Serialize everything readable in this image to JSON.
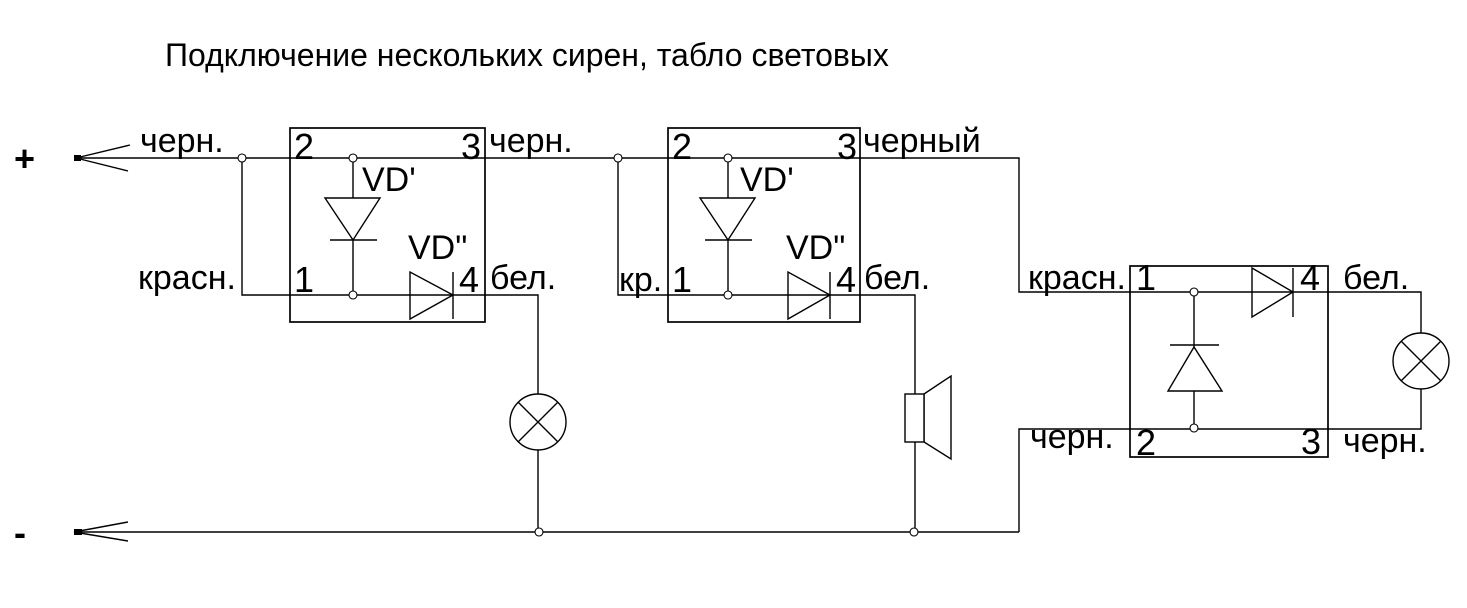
{
  "title": "Подключение нескольких сирен, табло световых",
  "colors": {
    "line": "#000000",
    "background": "#ffffff"
  },
  "power": {
    "plus_label": "+",
    "minus_label": "-",
    "plus_wire_color_label": "черн."
  },
  "modules": [
    {
      "pin1": "1",
      "pin2": "2",
      "pin3": "3",
      "pin4": "4",
      "diode_vertical_label": "VD'",
      "diode_horizontal_label": "VD\"",
      "input_bottom_wire_label": "красн.",
      "output_top_wire_label": "черн.",
      "output_bottom_wire_label": "бел.",
      "load": "lamp"
    },
    {
      "pin1": "1",
      "pin2": "2",
      "pin3": "3",
      "pin4": "4",
      "diode_vertical_label": "VD'",
      "diode_horizontal_label": "VD\"",
      "input_bottom_wire_label": "кр.",
      "output_top_wire_label": "черный",
      "output_bottom_wire_label": "бел.",
      "load": "siren-speaker"
    },
    {
      "pin1": "1",
      "pin2": "2",
      "pin3": "3",
      "pin4": "4",
      "input_top_wire_label": "красн.",
      "input_bottom_wire_label": "черн.",
      "output_top_wire_label": "бел.",
      "output_bottom_wire_label": "черн.",
      "load": "lamp"
    }
  ]
}
